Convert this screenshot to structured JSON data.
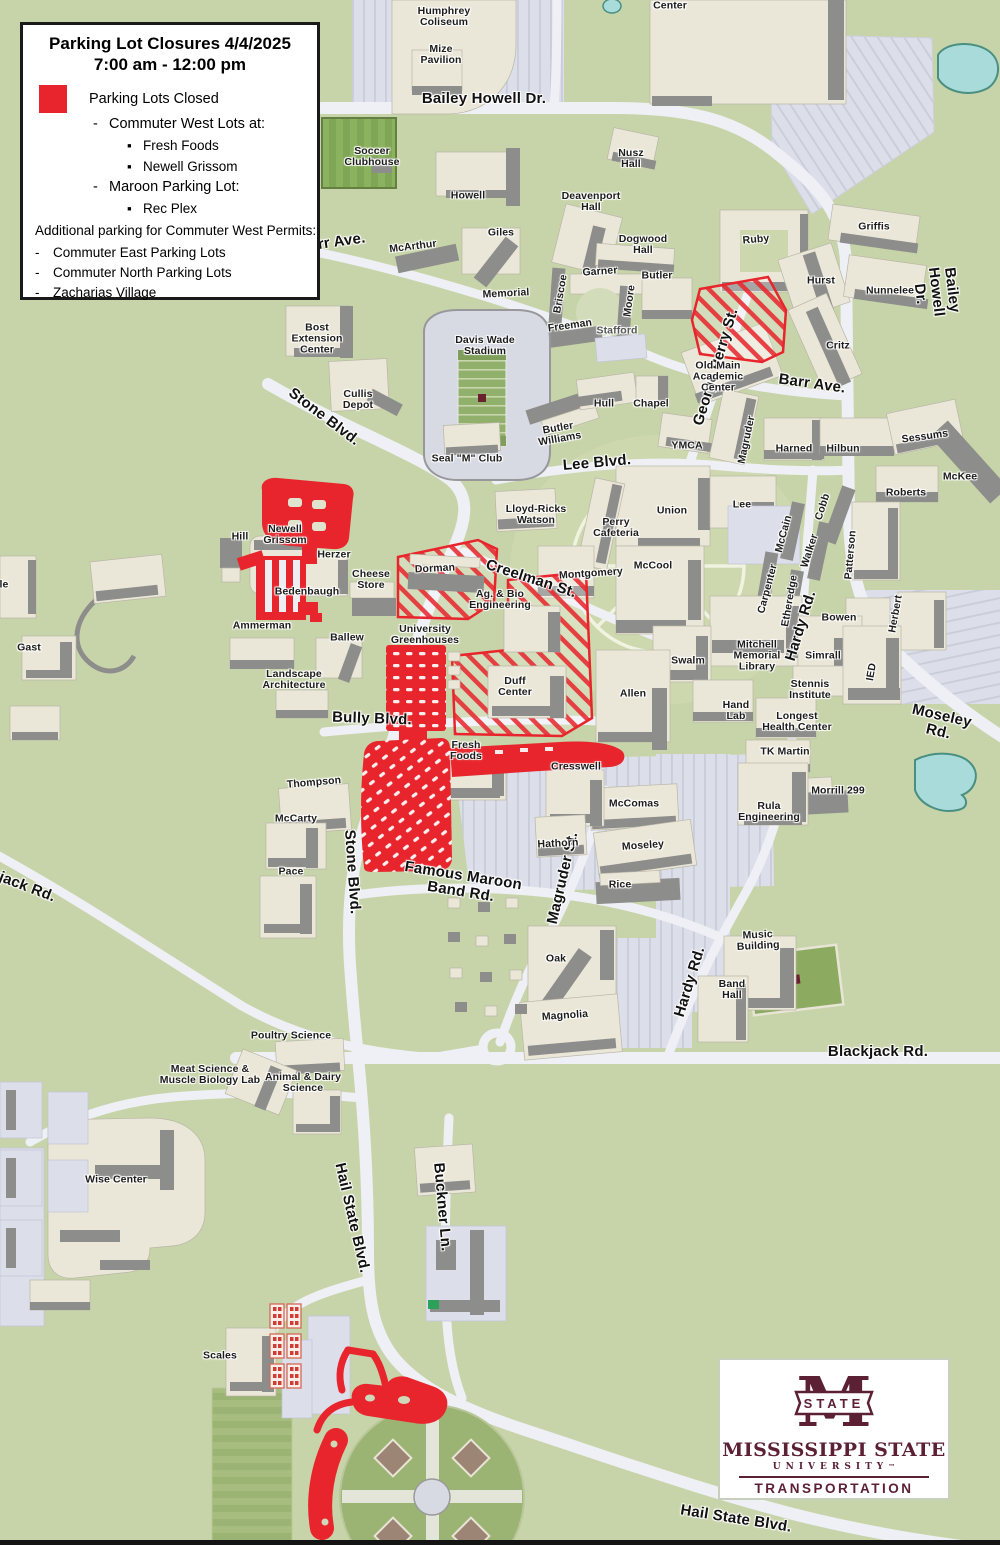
{
  "legend": {
    "title": "Parking Lot Closures 4/4/2025",
    "subtitle": "7:00 am - 12:00 pm",
    "closed_label": "Parking Lots Closed",
    "closed_items": [
      {
        "level": 1,
        "bullet": "-",
        "text": "Commuter West Lots at:"
      },
      {
        "level": 2,
        "bullet": "▪",
        "text": "Fresh Foods"
      },
      {
        "level": 2,
        "bullet": "▪",
        "text": "Newell Grissom"
      },
      {
        "level": 1,
        "bullet": "-",
        "text": "Maroon Parking Lot:"
      },
      {
        "level": 2,
        "bullet": "▪",
        "text": "Rec Plex"
      }
    ],
    "additional_heading": "Additional parking for Commuter West Permits:",
    "additional_items": [
      "Commuter East Parking Lots",
      "Commuter North Parking Lots",
      "Zacharias Village"
    ]
  },
  "logo": {
    "banner": "STATE",
    "m_letter": "M",
    "name": "MISSISSIPPI STATE",
    "sub": "UNIVERSITY",
    "tm": "™",
    "dept": "TRANSPORTATION"
  },
  "colors": {
    "closed_red": "#e8252c",
    "maroon": "#5c2034",
    "map_green": "#c7d4a9",
    "road": "#eef0f6",
    "pond": "#a9dbdb"
  },
  "map": {
    "road_labels": [
      {
        "t": "Bailey Howell Dr.",
        "x": 484,
        "y": 99,
        "r": 0
      },
      {
        "t": "Bailey Howell Dr.",
        "x": 936,
        "y": 292,
        "r": 83
      },
      {
        "t": "Barr Ave.",
        "x": 332,
        "y": 243,
        "r": -8
      },
      {
        "t": "Barr Ave.",
        "x": 812,
        "y": 384,
        "r": 8
      },
      {
        "t": "George Perry St.",
        "x": 716,
        "y": 367,
        "r": -73
      },
      {
        "t": "Stone Blvd.",
        "x": 324,
        "y": 417,
        "r": 37
      },
      {
        "t": "Stone Blvd.",
        "x": 352,
        "y": 872,
        "r": 86
      },
      {
        "t": "Lee Blvd.",
        "x": 597,
        "y": 463,
        "r": -5
      },
      {
        "t": "Creelman St.",
        "x": 531,
        "y": 579,
        "r": 18
      },
      {
        "t": "Bully Blvd.",
        "x": 372,
        "y": 719,
        "r": 2
      },
      {
        "t": "Famous Maroon\nBand Rd.",
        "x": 462,
        "y": 884,
        "r": 9
      },
      {
        "t": "Magruder St.",
        "x": 563,
        "y": 878,
        "r": -77
      },
      {
        "t": "Hardy Rd.",
        "x": 801,
        "y": 626,
        "r": -73
      },
      {
        "t": "Hardy Rd.",
        "x": 690,
        "y": 982,
        "r": -73
      },
      {
        "t": "Moseley Rd.",
        "x": 940,
        "y": 724,
        "r": 13
      },
      {
        "t": "Blackjack Rd.",
        "x": 878,
        "y": 1052,
        "r": 0
      },
      {
        "t": "Blackjack Rd.",
        "x": 8,
        "y": 880,
        "r": 21
      },
      {
        "t": "Hail State Blvd.",
        "x": 352,
        "y": 1218,
        "r": 77
      },
      {
        "t": "Hail State Blvd.",
        "x": 736,
        "y": 1519,
        "r": 9
      },
      {
        "t": "Buckner Ln.",
        "x": 442,
        "y": 1207,
        "r": 85
      }
    ],
    "building_labels": [
      {
        "t": "Center",
        "x": 670,
        "y": 6
      },
      {
        "t": "Humphrey\nColiseum",
        "x": 444,
        "y": 17
      },
      {
        "t": "Mize\nPavilion",
        "x": 441,
        "y": 55
      },
      {
        "t": "Soccer\nClubhouse",
        "x": 372,
        "y": 157
      },
      {
        "t": "Nusz\nHall",
        "x": 631,
        "y": 159
      },
      {
        "t": "Howell",
        "x": 468,
        "y": 196
      },
      {
        "t": "Deavenport\nHall",
        "x": 591,
        "y": 202
      },
      {
        "t": "Giles",
        "x": 501,
        "y": 233
      },
      {
        "t": "McArthur",
        "x": 413,
        "y": 247,
        "r": -7
      },
      {
        "t": "Dogwood\nHall",
        "x": 643,
        "y": 245
      },
      {
        "t": "Garner",
        "x": 600,
        "y": 272,
        "r": -4
      },
      {
        "t": "Butler",
        "x": 657,
        "y": 276
      },
      {
        "t": "Briscoe",
        "x": 561,
        "y": 294,
        "r": -80
      },
      {
        "t": "Moore",
        "x": 630,
        "y": 301,
        "r": -82
      },
      {
        "t": "Memorial",
        "x": 506,
        "y": 294,
        "r": -3
      },
      {
        "t": "Freeman",
        "x": 570,
        "y": 326,
        "r": -8
      },
      {
        "t": "Stafford",
        "x": 617,
        "y": 331,
        "c": "#565656"
      },
      {
        "t": "Ruby",
        "x": 756,
        "y": 240,
        "r": -5
      },
      {
        "t": "Griffis",
        "x": 874,
        "y": 227
      },
      {
        "t": "Hurst",
        "x": 821,
        "y": 281
      },
      {
        "t": "Nunnelee",
        "x": 890,
        "y": 291
      },
      {
        "t": "Critz",
        "x": 838,
        "y": 346
      },
      {
        "t": "Old Main\nAcademic\nCenter",
        "x": 718,
        "y": 377
      },
      {
        "t": "Bost\nExtension\nCenter",
        "x": 317,
        "y": 339
      },
      {
        "t": "Davis Wade\nStadium",
        "x": 485,
        "y": 346
      },
      {
        "t": "Cullis\nDepot",
        "x": 358,
        "y": 400
      },
      {
        "t": "Hull",
        "x": 604,
        "y": 404
      },
      {
        "t": "Chapel",
        "x": 651,
        "y": 404
      },
      {
        "t": "Butler\nWilliams",
        "x": 559,
        "y": 434,
        "r": -10
      },
      {
        "t": "Seal \"M\" Club",
        "x": 467,
        "y": 459
      },
      {
        "t": "YMCA",
        "x": 687,
        "y": 446
      },
      {
        "t": "Magruder",
        "x": 747,
        "y": 440,
        "r": -78
      },
      {
        "t": "Harned",
        "x": 794,
        "y": 449
      },
      {
        "t": "Hilbun",
        "x": 843,
        "y": 449
      },
      {
        "t": "Sessums",
        "x": 925,
        "y": 437,
        "r": -8
      },
      {
        "t": "McKee",
        "x": 960,
        "y": 477
      },
      {
        "t": "Roberts",
        "x": 906,
        "y": 493
      },
      {
        "t": "Lee",
        "x": 742,
        "y": 505
      },
      {
        "t": "Union",
        "x": 672,
        "y": 511
      },
      {
        "t": "Perry\nCafeteria",
        "x": 616,
        "y": 528
      },
      {
        "t": "Lloyd-Ricks\nWatson",
        "x": 536,
        "y": 515
      },
      {
        "t": "Montgomery",
        "x": 591,
        "y": 574,
        "r": -4
      },
      {
        "t": "McCool",
        "x": 653,
        "y": 566
      },
      {
        "t": "Cobb",
        "x": 823,
        "y": 507,
        "r": -72
      },
      {
        "t": "McCain",
        "x": 784,
        "y": 534,
        "r": -75
      },
      {
        "t": "Walker",
        "x": 810,
        "y": 551,
        "r": -72
      },
      {
        "t": "Carpenter",
        "x": 768,
        "y": 589,
        "r": -75
      },
      {
        "t": "Etheredge",
        "x": 790,
        "y": 601,
        "r": -80
      },
      {
        "t": "Patterson",
        "x": 851,
        "y": 555,
        "r": -85
      },
      {
        "t": "Bowen",
        "x": 839,
        "y": 618
      },
      {
        "t": "Herbert",
        "x": 896,
        "y": 614,
        "r": -80
      },
      {
        "t": "Swalm",
        "x": 688,
        "y": 661
      },
      {
        "t": "Mitchell\nMemorial\nLibrary",
        "x": 757,
        "y": 656
      },
      {
        "t": "Simrall",
        "x": 823,
        "y": 656
      },
      {
        "t": "IED",
        "x": 872,
        "y": 672,
        "r": -80
      },
      {
        "t": "Stennis\nInstitute",
        "x": 810,
        "y": 690
      },
      {
        "t": "Allen",
        "x": 633,
        "y": 694
      },
      {
        "t": "Hand\nLab",
        "x": 736,
        "y": 711
      },
      {
        "t": "Longest\nHealth Center",
        "x": 797,
        "y": 722
      },
      {
        "t": "TK Martin",
        "x": 785,
        "y": 752
      },
      {
        "t": "Morrill 299",
        "x": 838,
        "y": 791
      },
      {
        "t": "Rula\nEngineering",
        "x": 769,
        "y": 812
      },
      {
        "t": "Hill",
        "x": 240,
        "y": 537
      },
      {
        "t": "Newell\nGrissom",
        "x": 285,
        "y": 535
      },
      {
        "t": "Herzer",
        "x": 334,
        "y": 555
      },
      {
        "t": "Cheese\nStore",
        "x": 371,
        "y": 580
      },
      {
        "t": "Bedenbaugh",
        "x": 307,
        "y": 592
      },
      {
        "t": "Ammerman",
        "x": 262,
        "y": 626
      },
      {
        "t": "Ballew",
        "x": 347,
        "y": 638
      },
      {
        "t": "Landscape\nArchitecture",
        "x": 294,
        "y": 680
      },
      {
        "t": "Gast",
        "x": 29,
        "y": 648
      },
      {
        "t": "le",
        "x": 4,
        "y": 585
      },
      {
        "t": "Dorman",
        "x": 435,
        "y": 569,
        "r": -3
      },
      {
        "t": "University\nGreenhouses",
        "x": 425,
        "y": 635
      },
      {
        "t": "Ag. & Bio\nEngineering",
        "x": 500,
        "y": 600
      },
      {
        "t": "Duff\nCenter",
        "x": 515,
        "y": 687
      },
      {
        "t": "Fresh\nFoods",
        "x": 466,
        "y": 751
      },
      {
        "t": "Cresswell",
        "x": 576,
        "y": 767
      },
      {
        "t": "Thompson",
        "x": 314,
        "y": 783,
        "r": -5
      },
      {
        "t": "McCarty",
        "x": 296,
        "y": 819
      },
      {
        "t": "Pace",
        "x": 291,
        "y": 872
      },
      {
        "t": "McComas",
        "x": 634,
        "y": 804
      },
      {
        "t": "Moseley",
        "x": 643,
        "y": 846,
        "r": -4
      },
      {
        "t": "Rice",
        "x": 620,
        "y": 885
      },
      {
        "t": "Hathorn",
        "x": 558,
        "y": 844,
        "r": -3
      },
      {
        "t": "Oak",
        "x": 556,
        "y": 959
      },
      {
        "t": "Magnolia",
        "x": 565,
        "y": 1016,
        "r": -4
      },
      {
        "t": "Music\nBuilding",
        "x": 758,
        "y": 941,
        "r": -3
      },
      {
        "t": "Band\nHall",
        "x": 732,
        "y": 990
      },
      {
        "t": "Poultry Science",
        "x": 291,
        "y": 1036
      },
      {
        "t": "Meat Science &\nMuscle Biology Lab",
        "x": 210,
        "y": 1075
      },
      {
        "t": "Animal & Dairy\nScience",
        "x": 303,
        "y": 1083
      },
      {
        "t": "Wise Center",
        "x": 116,
        "y": 1180
      },
      {
        "t": "Scales",
        "x": 220,
        "y": 1356
      }
    ]
  }
}
